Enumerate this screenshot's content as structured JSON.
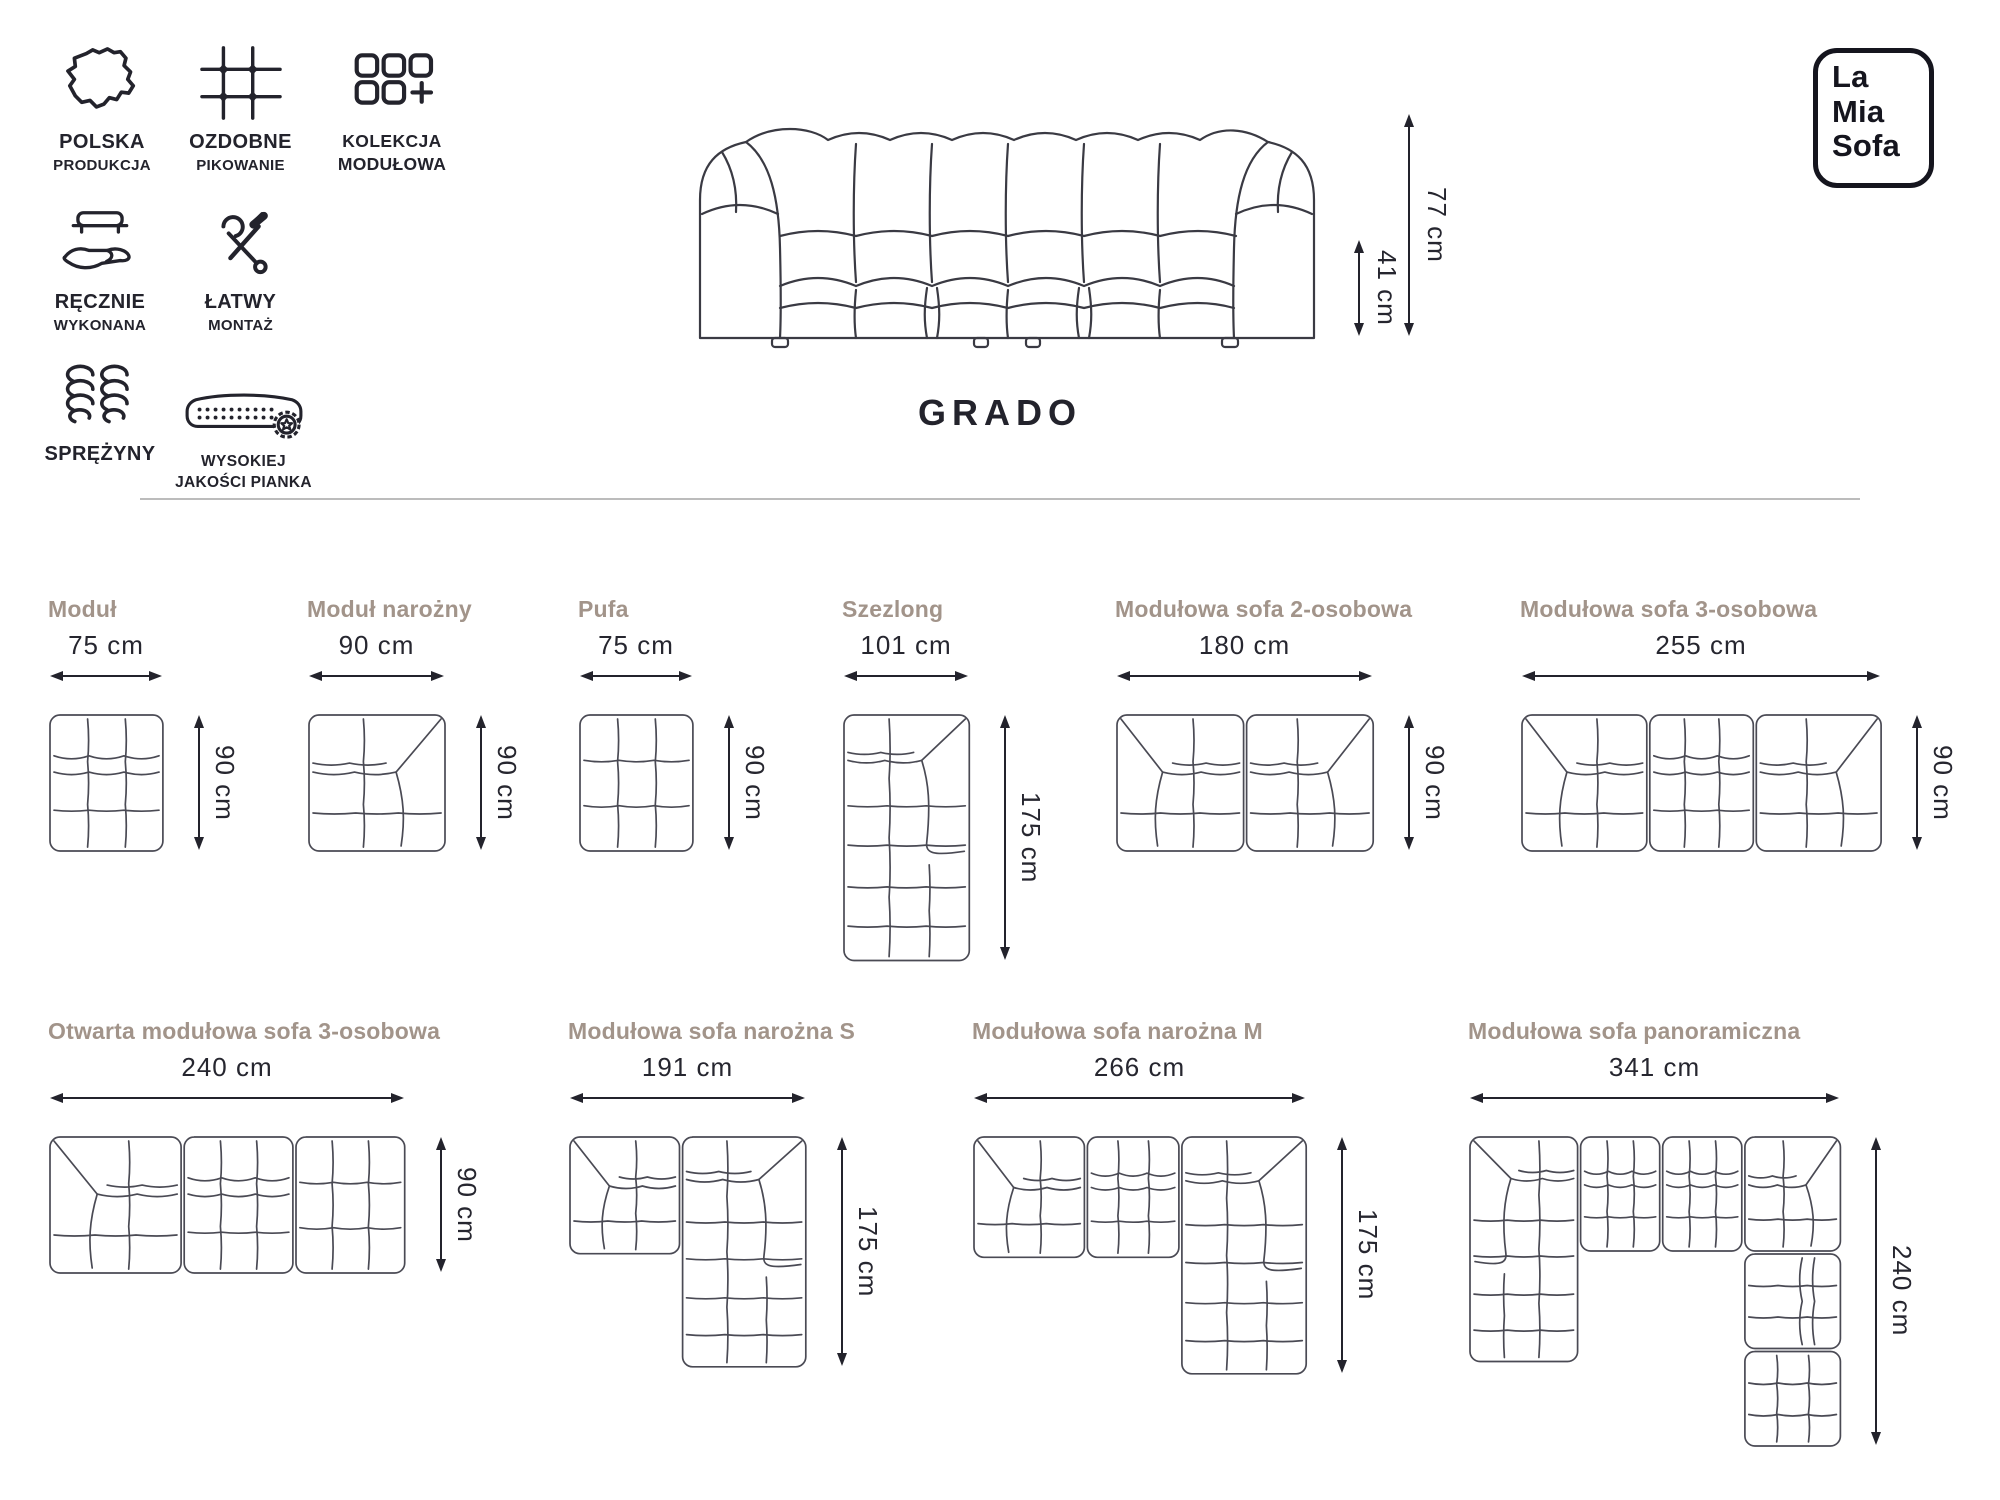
{
  "brand": {
    "line1": "La",
    "line2": "Mia",
    "line3": "Sofa"
  },
  "product": {
    "name": "GRADO",
    "height_label": "77 cm",
    "seat_height_label": "41 cm"
  },
  "features": [
    {
      "icon": "poland-map",
      "line1": "POLSKA",
      "line2": "PRODUKCJA"
    },
    {
      "icon": "quilting-grid",
      "line1": "OZDOBNE",
      "line2": "PIKOWANIE"
    },
    {
      "icon": "modular-collection",
      "line1": "KOLEKCJA",
      "line2": "MODUŁOWA"
    },
    {
      "icon": "sofa-in-hand",
      "line1": "RĘCZNIE",
      "line2": "WYKONANA"
    },
    {
      "icon": "tools",
      "line1": "ŁATWY",
      "line2": "MONTAŻ"
    },
    {
      "icon": "springs",
      "line1": "SPRĘŻYNY",
      "line2": ""
    },
    {
      "icon": "foam-badge",
      "line1": "WYSOKIEJ",
      "line2": "JAKOŚCI PIANKA"
    }
  ],
  "colors": {
    "ink": "#23232c",
    "drawing_line": "#4a4a54",
    "diagram_label": "#a2948a",
    "divider": "#bcbcbc"
  },
  "diagrams": [
    {
      "name": "Moduł",
      "width_label": "75 cm",
      "height_label": "90 cm",
      "modules": [
        {
          "type": "mid",
          "x": 0,
          "y": 0,
          "w": 75,
          "h": 90
        }
      ]
    },
    {
      "name": "Moduł narożny",
      "width_label": "90 cm",
      "height_label": "90 cm",
      "modules": [
        {
          "type": "corner-r",
          "x": 0,
          "y": 0,
          "w": 90,
          "h": 90
        }
      ]
    },
    {
      "name": "Pufa",
      "width_label": "75 cm",
      "height_label": "90 cm",
      "modules": [
        {
          "type": "plain",
          "x": 0,
          "y": 0,
          "w": 75,
          "h": 90
        }
      ]
    },
    {
      "name": "Szezlong",
      "width_label": "101 cm",
      "height_label": "175 cm",
      "modules": [
        {
          "type": "chaise-r",
          "x": 0,
          "y": 0,
          "w": 101,
          "h": 175
        }
      ]
    },
    {
      "name": "Modułowa sofa 2-osobowa",
      "width_label": "180 cm",
      "height_label": "90 cm",
      "modules": [
        {
          "type": "corner-l",
          "x": 0,
          "y": 0,
          "w": 90,
          "h": 90
        },
        {
          "type": "corner-r",
          "x": 90,
          "y": 0,
          "w": 90,
          "h": 90
        }
      ]
    },
    {
      "name": "Modułowa sofa 3-osobowa",
      "width_label": "255 cm",
      "height_label": "90 cm",
      "modules": [
        {
          "type": "corner-l",
          "x": 0,
          "y": 0,
          "w": 90,
          "h": 90
        },
        {
          "type": "mid",
          "x": 90,
          "y": 0,
          "w": 75,
          "h": 90
        },
        {
          "type": "corner-r",
          "x": 165,
          "y": 0,
          "w": 90,
          "h": 90
        }
      ]
    },
    {
      "name": "Otwarta modułowa sofa 3-osobowa",
      "width_label": "240 cm",
      "height_label": "90 cm",
      "modules": [
        {
          "type": "corner-l",
          "x": 0,
          "y": 0,
          "w": 90,
          "h": 90
        },
        {
          "type": "mid",
          "x": 90,
          "y": 0,
          "w": 75,
          "h": 90
        },
        {
          "type": "plain",
          "x": 165,
          "y": 0,
          "w": 75,
          "h": 90
        }
      ]
    },
    {
      "name": "Modułowa sofa narożna S",
      "width_label": "191 cm",
      "height_label": "175 cm",
      "modules": [
        {
          "type": "corner-l",
          "x": 0,
          "y": 0,
          "w": 90,
          "h": 90
        },
        {
          "type": "chaise-r",
          "x": 90,
          "y": 0,
          "w": 101,
          "h": 175
        }
      ]
    },
    {
      "name": "Modułowa sofa narożna M",
      "width_label": "266 cm",
      "height_label": "175 cm",
      "modules": [
        {
          "type": "corner-l",
          "x": 0,
          "y": 0,
          "w": 90,
          "h": 90
        },
        {
          "type": "mid",
          "x": 90,
          "y": 0,
          "w": 75,
          "h": 90
        },
        {
          "type": "chaise-r",
          "x": 165,
          "y": 0,
          "w": 101,
          "h": 175
        }
      ]
    },
    {
      "name": "Modułowa sofa panoramiczna",
      "width_label": "341 cm",
      "height_label": "240 cm",
      "modules": [
        {
          "type": "chaise-dl",
          "x": 0,
          "y": 0,
          "w": 101,
          "h": 175
        },
        {
          "type": "mid",
          "x": 101,
          "y": 0,
          "w": 75,
          "h": 90
        },
        {
          "type": "mid",
          "x": 176,
          "y": 0,
          "w": 75,
          "h": 90
        },
        {
          "type": "corner-r",
          "x": 251,
          "y": 0,
          "w": 90,
          "h": 90
        },
        {
          "type": "mid-v",
          "x": 251,
          "y": 90,
          "w": 90,
          "h": 75
        },
        {
          "type": "plain",
          "x": 251,
          "y": 165,
          "w": 90,
          "h": 75
        }
      ]
    }
  ]
}
